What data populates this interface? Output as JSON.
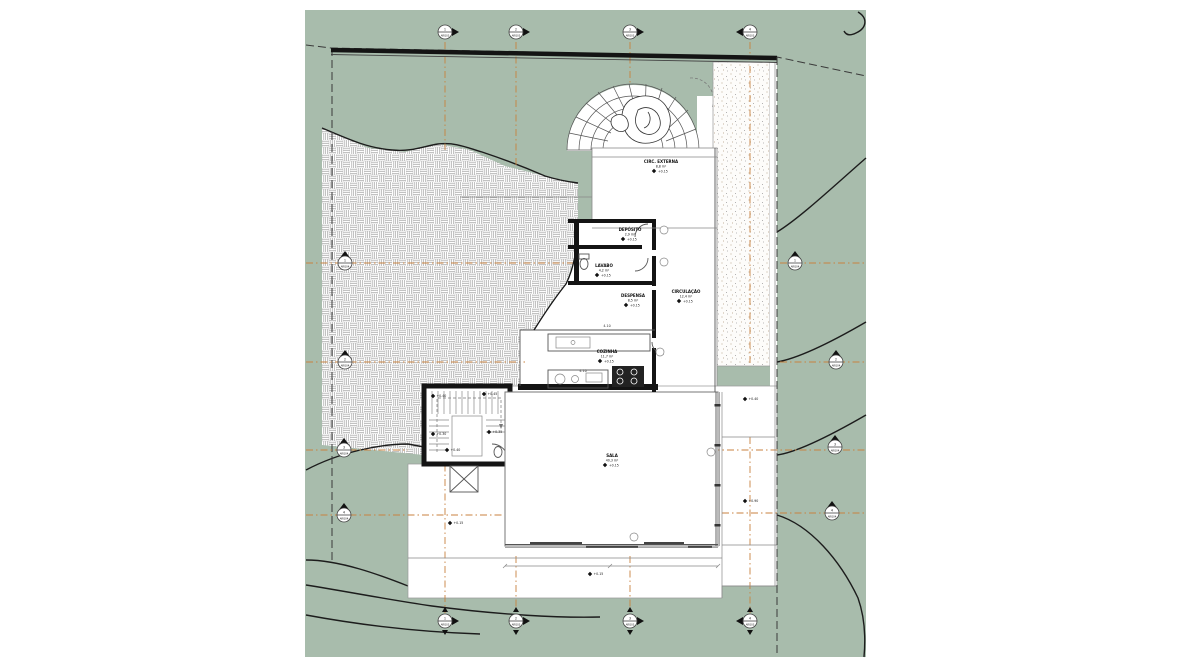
{
  "colors": {
    "site_green": "#a8bcac",
    "paper_white": "#ffffff",
    "grid_accent_orange": "#c8823f",
    "line_black": "#141414"
  },
  "rooms": [
    {
      "name": "CIRC. EXTERNA",
      "area": "8,8 m²",
      "level": "+0.15"
    },
    {
      "name": "DEPÓSITO",
      "area": "2,9 m²",
      "level": "+0.15"
    },
    {
      "name": "LAVABO",
      "area": "4,2 m²",
      "level": "+0.15"
    },
    {
      "name": "DESPENSA",
      "area": "8,5 m²",
      "level": "+0.15"
    },
    {
      "name": "COZINHA",
      "area": "11,7 m²",
      "level": "+0.15"
    },
    {
      "name": "CIRCULAÇÃO",
      "area": "12,4 m²",
      "level": "+0.15"
    },
    {
      "name": "SALA",
      "area": "40,3 m²",
      "level": "+0.15"
    }
  ],
  "spots": [
    {
      "label": "+0.40"
    },
    {
      "label": "+0.45"
    },
    {
      "label": "+0.30"
    },
    {
      "label": "+0.35"
    },
    {
      "label": "+0.40"
    },
    {
      "label": "+0.15"
    },
    {
      "label": "+0.15"
    },
    {
      "label": "+0.40"
    },
    {
      "label": "+0.90"
    }
  ],
  "dims": [
    {
      "label": "4.10"
    },
    {
      "label": "4.10"
    }
  ],
  "grid": {
    "top": [
      {
        "num": "1",
        "sheet": "ARQ03"
      },
      {
        "num": "2",
        "sheet": "ARQ03"
      },
      {
        "num": "3",
        "sheet": "ARQ03"
      },
      {
        "num": "4",
        "sheet": "ARQ03"
      }
    ],
    "bottom": [
      {
        "num": "1",
        "sheet": "ARQ03"
      },
      {
        "num": "2",
        "sheet": "ARQ03"
      },
      {
        "num": "3",
        "sheet": "ARQ03"
      },
      {
        "num": "4",
        "sheet": "ARQ03"
      }
    ],
    "left": [
      {
        "num": "1",
        "sheet": "ARQ04"
      },
      {
        "num": "2",
        "sheet": "ARQ04"
      },
      {
        "num": "3",
        "sheet": "ARQ04"
      },
      {
        "num": "4",
        "sheet": "ARQ04"
      }
    ],
    "right": [
      {
        "num": "1",
        "sheet": "ARQ04"
      },
      {
        "num": "2",
        "sheet": "ARQ04"
      },
      {
        "num": "3",
        "sheet": "ARQ04"
      },
      {
        "num": "4",
        "sheet": "ARQ04"
      }
    ]
  }
}
